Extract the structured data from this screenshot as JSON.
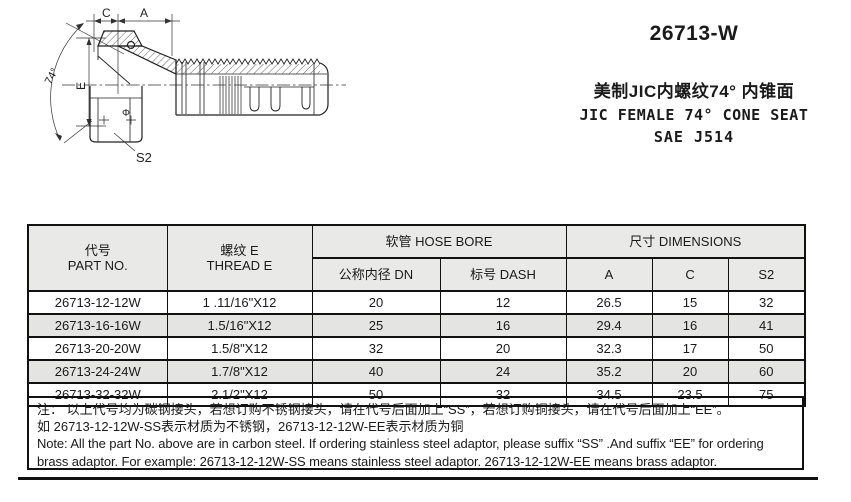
{
  "product": {
    "model": "26713-W",
    "title_cn": "美制JIC内螺纹74° 内锥面",
    "title_en": "JIC FEMALE 74°  CONE SEAT",
    "standard": "SAE J514"
  },
  "drawing": {
    "labels": {
      "dim_c": "C",
      "dim_a": "A",
      "angle": "74°",
      "dim_e": "E",
      "phi": "Φ",
      "dim_s2": "S2"
    }
  },
  "table": {
    "headers": {
      "part_no_cn": "代号",
      "part_no_en": "PART NO.",
      "thread_cn": "螺纹 E",
      "thread_en": "THREAD E",
      "hose_bore": "软管 HOSE BORE",
      "dn": "公称内径 DN",
      "dash": "标号 DASH",
      "dimensions": "尺寸 DIMENSIONS",
      "a": "A",
      "c": "C",
      "s2": "S2"
    },
    "rows": [
      {
        "part_no": "26713-12-12W",
        "thread": "1 .11/16\"X12",
        "dn": "20",
        "dash": "12",
        "a": "26.5",
        "c": "15",
        "s2": "32",
        "shaded": false
      },
      {
        "part_no": "26713-16-16W",
        "thread": "1.5/16\"X12",
        "dn": "25",
        "dash": "16",
        "a": "29.4",
        "c": "16",
        "s2": "41",
        "shaded": true
      },
      {
        "part_no": "26713-20-20W",
        "thread": "1.5/8\"X12",
        "dn": "32",
        "dash": "20",
        "a": "32.3",
        "c": "17",
        "s2": "50",
        "shaded": false
      },
      {
        "part_no": "26713-24-24W",
        "thread": "1.7/8\"X12",
        "dn": "40",
        "dash": "24",
        "a": "35.2",
        "c": "20",
        "s2": "60",
        "shaded": true
      },
      {
        "part_no": "26713-32-32W",
        "thread": "2.1/2\"X12",
        "dn": "50",
        "dash": "32",
        "a": "34.5",
        "c": "23.5",
        "s2": "75",
        "shaded": false
      }
    ]
  },
  "notes": {
    "line1_cn": "注： 以上代号均为碳钢接头，若想订购不锈钢接头，请在代号后面加上“SS”，若想订购铜接头，请在代号后面加上“EE”。",
    "line2_cn": "如 26713-12-12W-SS表示材质为不锈钢，26713-12-12W-EE表示材质为铜",
    "line1_en": "Note:  All the part No. above are in carbon steel. If ordering stainless steel adaptor, please suffix “SS” .And suffix “EE” for ordering",
    "line2_en": "brass adaptor. For example: 26713-12-12W-SS  means stainless steel adaptor. 26713-12-12W-EE means brass adaptor."
  },
  "colors": {
    "line": "#111111",
    "header_bg": "#e9e9e8",
    "row_alt_bg": "#e4e4e3"
  }
}
